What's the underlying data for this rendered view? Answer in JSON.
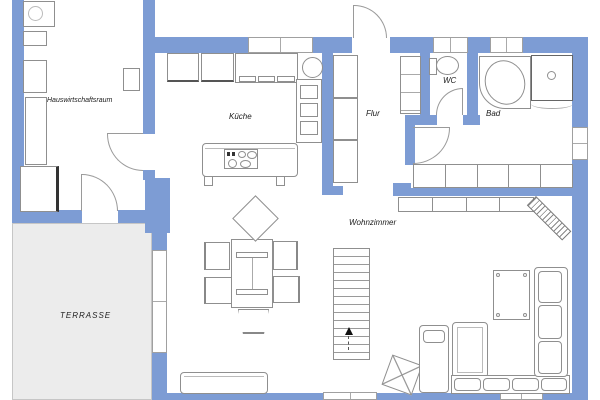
{
  "colors": {
    "wall": "#7d9cd4",
    "terrace": "#ececec",
    "line": "#8f8f8f"
  },
  "rooms": {
    "utility": {
      "label": "Hauswirtschaftsraum"
    },
    "kitchen": {
      "label": "Küche"
    },
    "hall": {
      "label": "Flur"
    },
    "wc": {
      "label": "WC"
    },
    "bath": {
      "label": "Bad"
    },
    "living": {
      "label": "Wohnzimmer"
    },
    "terrace": {
      "label": "TERRASSE"
    }
  },
  "furniture_symbols": [
    "washing-machine",
    "storage-box",
    "storage-cabinet",
    "freezer",
    "wall-unit",
    "refrigerator",
    "oven",
    "kitchen-counter",
    "kitchen-sink",
    "kitchen-island",
    "cooktop",
    "wardrobe",
    "hall-shelf",
    "toilet",
    "corner-bathtub",
    "shower",
    "sideboard",
    "lowboard",
    "radiator",
    "stairs",
    "dining-table",
    "dining-chair",
    "tv-lowboard",
    "beanbag",
    "chaise-longue",
    "corner-sofa",
    "coffee-table"
  ]
}
